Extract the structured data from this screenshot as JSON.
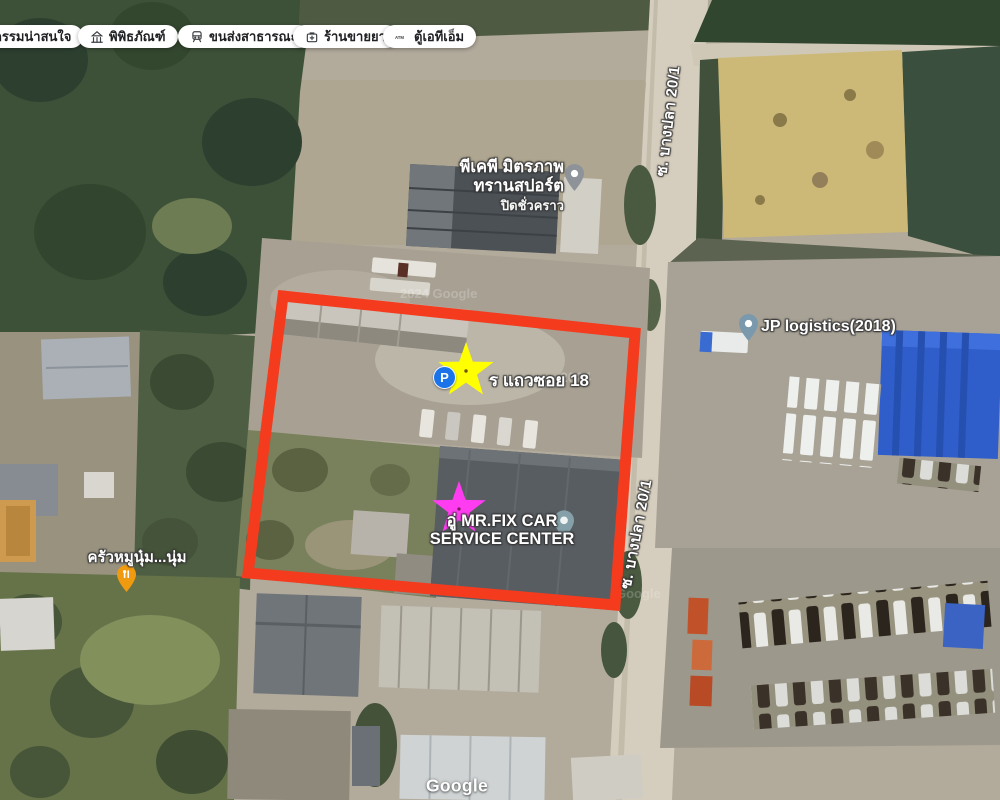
{
  "filter_chips": [
    {
      "label": "กรรมน่าสนใจ"
    },
    {
      "label": "พิพิธภัณฑ์"
    },
    {
      "label": "ขนส่งสาธารณะ"
    },
    {
      "label": "ร้านขายยา"
    },
    {
      "label": "ตู้เอทีเอ็ม",
      "icon_text": "ATM"
    }
  ],
  "pois": {
    "pkp": {
      "line1": "พีเคพี มิตรภาพ",
      "line2": "ทรานสปอร์ต",
      "status": "ปิดชั่วคราว"
    },
    "parking_row": {
      "icon_letter": "P",
      "label": "ร แถวซอย 18"
    },
    "jp": {
      "label": "JP logistics(2018)"
    },
    "mrfix": {
      "line1": "อู่ MR.FIX CAR",
      "line2": "SERVICE CENTER"
    },
    "restaurant": {
      "label": "ครัวหมูนุ๋ม...นุ่ม"
    }
  },
  "road_labels": {
    "upper": "ซ. บางปลา 20/1",
    "lower": "ซ. บางปลา 20/1"
  },
  "watermarks": {
    "top": "2024 Google",
    "middle": "2024",
    "bottom": "Google"
  },
  "branding": {
    "google_logo": "Google"
  },
  "annotations": {
    "red_box_color": "#f43b1e",
    "star_top_color": "#ffff00",
    "star_bottom_color": "#ff3cf0",
    "parking_blue": "#1a73e8"
  }
}
